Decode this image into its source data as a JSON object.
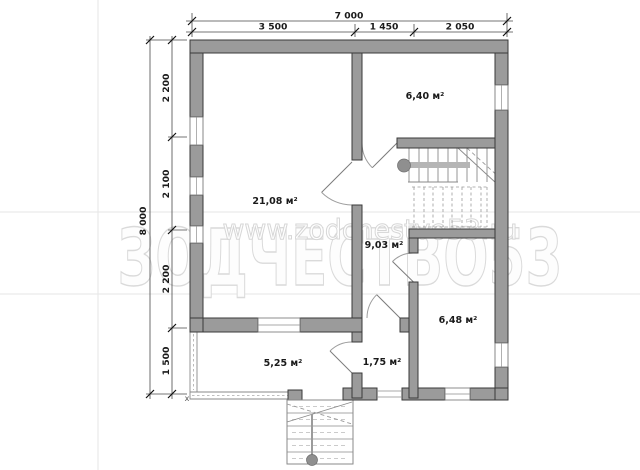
{
  "dimensions": {
    "top_total": "7 000",
    "top_segments": [
      "3 500",
      "1 450",
      "2 050"
    ],
    "left_total": "8 000",
    "left_segments": [
      "2 200",
      "2 100",
      "2 200",
      "1 500"
    ]
  },
  "rooms": [
    {
      "id": "living-room",
      "area": "21,08 м²"
    },
    {
      "id": "room-top-right",
      "area": "6,40 м²"
    },
    {
      "id": "hall",
      "area": "9,03 м²"
    },
    {
      "id": "room-bottom-right",
      "area": "6,48 м²"
    },
    {
      "id": "veranda",
      "area": "5,25 м²"
    },
    {
      "id": "entry",
      "area": "1,75 м²"
    }
  ],
  "watermark": {
    "brand": "ЗОДЧЕСТВО53",
    "site": "www.zodchestvo53.ru"
  },
  "marks": {
    "corner": "х"
  },
  "colors": {
    "wall_fill": "#9b9b9b",
    "wall_stroke": "#3a3a3a",
    "dimension": "#1a1a1a",
    "watermark_outline": "#dadada",
    "background": "#ffffff"
  }
}
